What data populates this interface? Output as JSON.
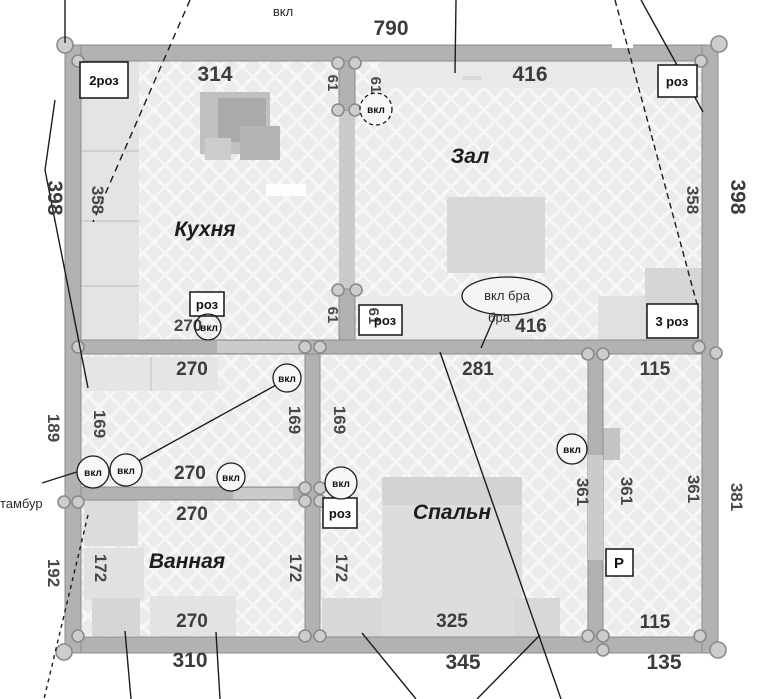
{
  "plan_title": "apartment electrical floor plan",
  "colors": {
    "wall": "#b2b2b2",
    "wall_edge": "#8c8c8c",
    "floor": "#ebebeb",
    "hatch_line": "#f7f7f7",
    "node_fill": "#cdcdcd",
    "annotation_line": "#1c1c1c"
  },
  "rooms": {
    "kitchen": "Кухня",
    "living": "Зал",
    "bathroom": "Ванная",
    "bedroom": "Спальн",
    "vestibule": "тамбур"
  },
  "electrical": {
    "switch": "вкл",
    "socket": "роз",
    "double_socket": "2роз",
    "triple_socket": "3 роз",
    "sconce_switch": "вкл бра",
    "sconce": "бра",
    "panel": "Р"
  },
  "dimensions": {
    "d61": "61",
    "d115": "115",
    "d135": "135",
    "d169": "169",
    "d172": "172",
    "d189": "189",
    "d192": "192",
    "d270": "270",
    "d281": "281",
    "d310": "310",
    "d314": "314",
    "d325": "325",
    "d345": "345",
    "d358": "358",
    "d361": "361",
    "d381": "381",
    "d398": "398",
    "d416": "416",
    "d790": "790"
  }
}
